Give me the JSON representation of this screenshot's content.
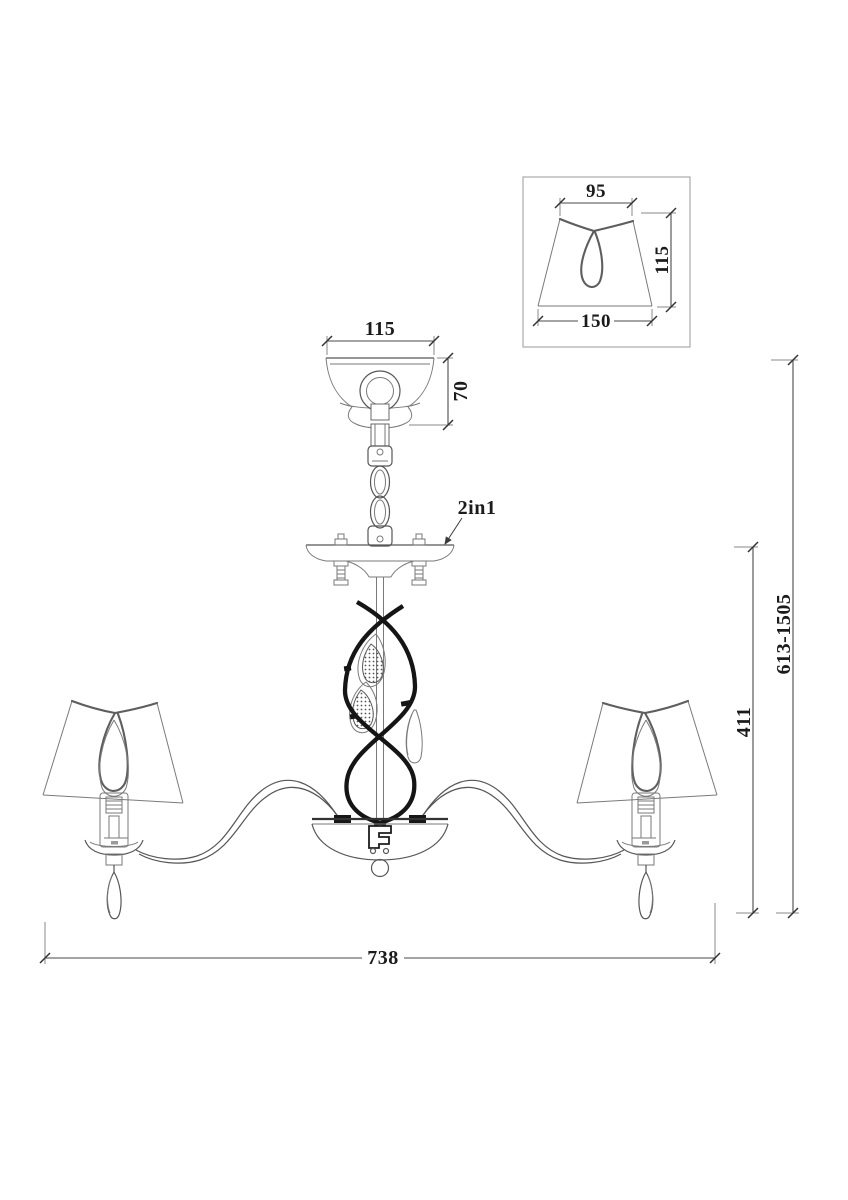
{
  "drawing": {
    "type": "chandelier-dimension-drawing",
    "dimensions": {
      "shade_top_width": "95",
      "shade_bottom_width": "150",
      "shade_height": "115",
      "canopy_width": "115",
      "canopy_height": "70",
      "fixture_width": "738",
      "body_height": "411",
      "overall_height": "613-1505"
    },
    "labels": {
      "mount_type": "2in1"
    },
    "colors": {
      "background": "#ffffff",
      "thin_line": "#7a7a7a",
      "dimension_line": "#4a4a4a",
      "bold_line": "#151515",
      "text": "#1b1b1b"
    }
  }
}
